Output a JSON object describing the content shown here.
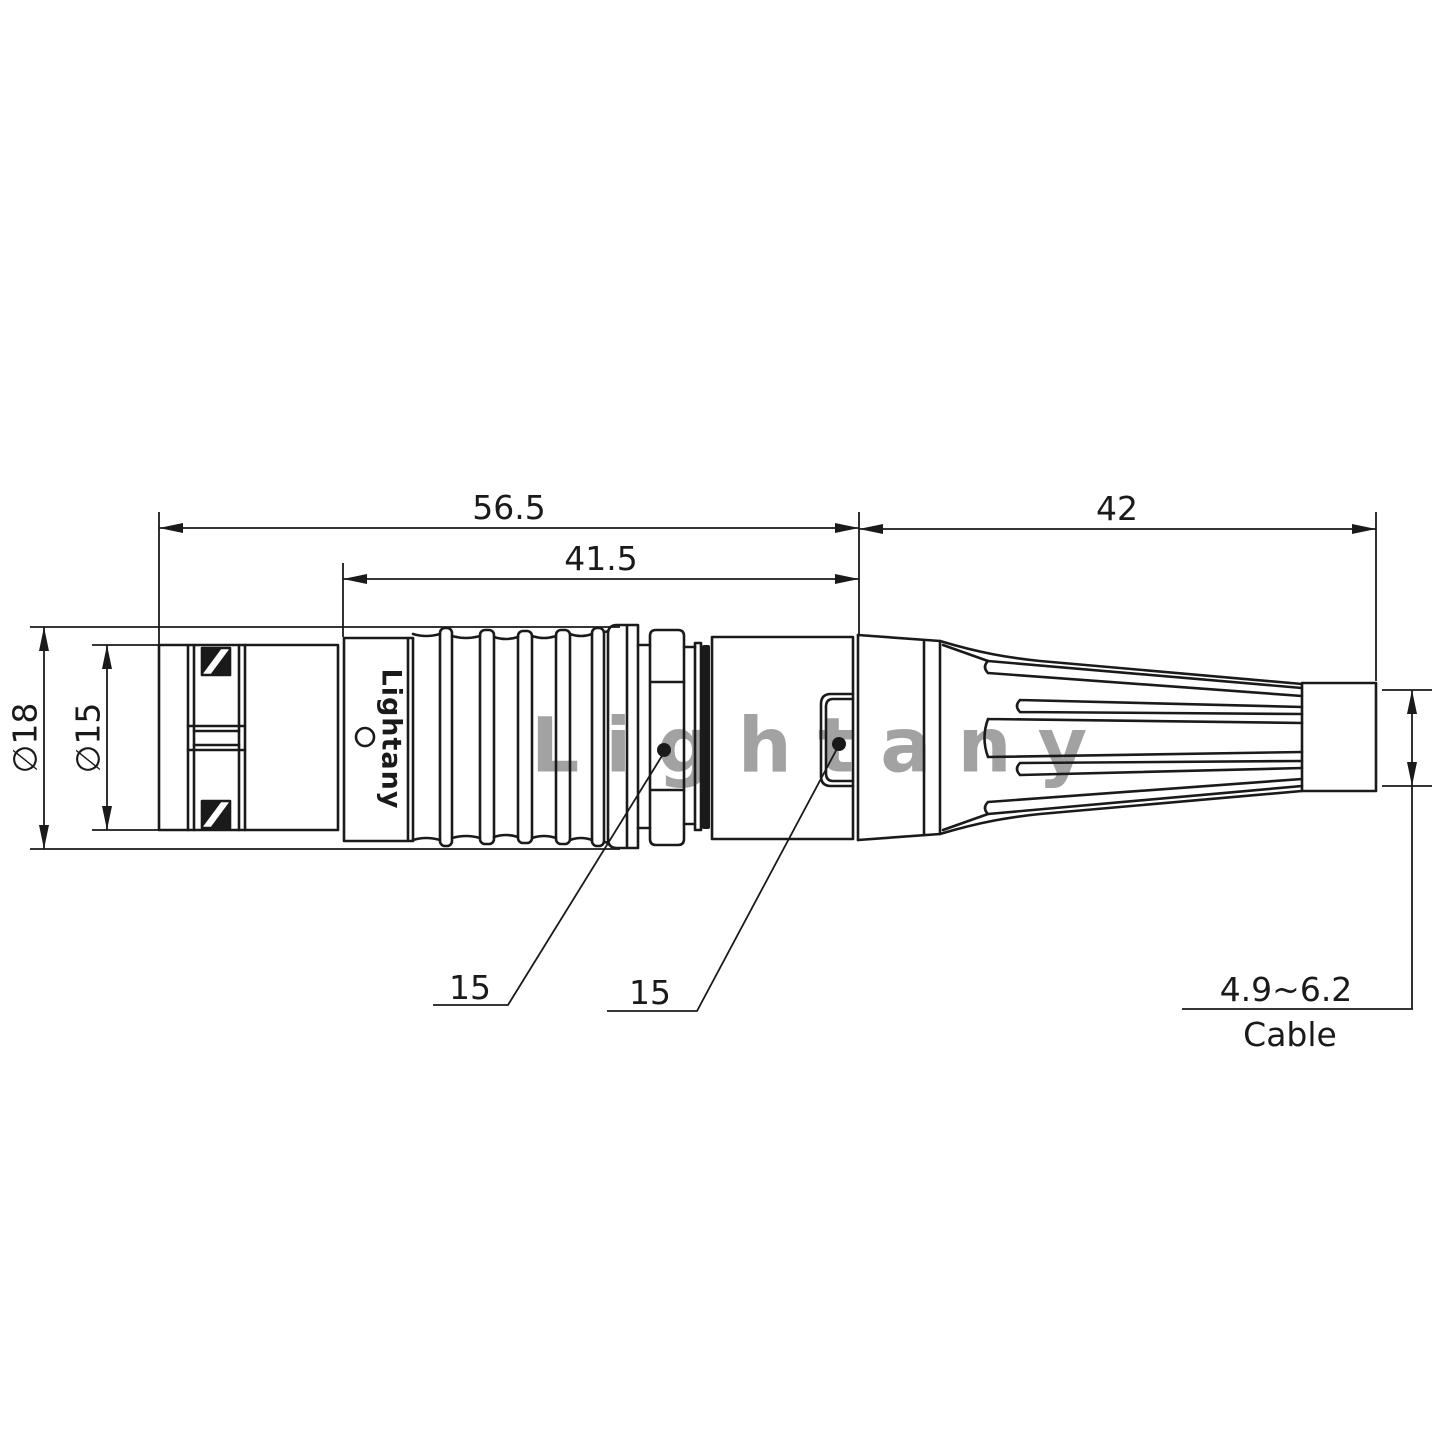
{
  "dims": {
    "total_length": "56.5",
    "front_length": "41.5",
    "boot_length": "42",
    "dia_outer": "∅18",
    "dia_front": "∅15",
    "callout_nut": "15",
    "callout_backshell": "15",
    "cable_range": "4.9~6.2",
    "cable_label": "Cable"
  },
  "branding": {
    "body_marking": "Lightany",
    "watermark": "Lightany"
  },
  "colors": {
    "line": "#1a1a1a",
    "watermark": "#e4717e"
  }
}
